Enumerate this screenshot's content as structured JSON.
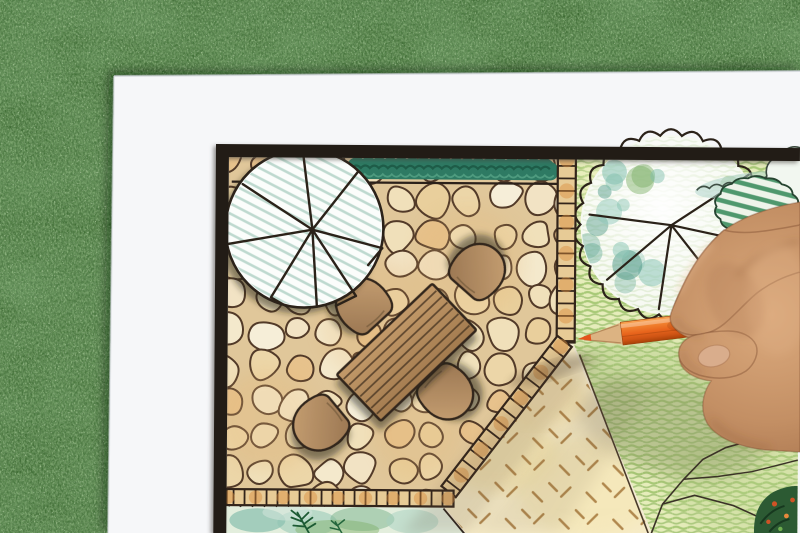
{
  "scene": {
    "kind": "photograph",
    "subject": "garden-landscape-plan-drawing-on-grass",
    "objects": [
      "grass-background",
      "white-paper-sheet",
      "garden-plan-drawing",
      "tree-symbols",
      "flagstone-patio",
      "garden-table",
      "garden-chairs",
      "hedges",
      "crayon-lawn",
      "gravel-area",
      "brick-edging",
      "orange-pencil",
      "artist-hand"
    ]
  },
  "counts": {
    "chairs": 4,
    "tree_symbols": 2
  },
  "palette": {
    "grass_base": "#3c6a31",
    "grass_dark": "#1e3d18",
    "grass_light": "#9cc27e",
    "paper": "#f6f7f9",
    "frame": "#241a14",
    "plan_bg": "#f3ead3",
    "grout": "#e0c79a",
    "stone_line": "#523a28",
    "hedge_green": "#2e7a63",
    "hedge_deep": "#1b5743",
    "lawn_base": "#e6edbb",
    "lawn_stroke": "#98c167",
    "gravel_base": "#f7ecc8",
    "gravel_dash": "#aa7d42",
    "ladder_fill": "#e7cb96",
    "ladder_line": "#32241a",
    "tree1_hatch": "#b4d3c8",
    "ink": "#2b2219",
    "wood_fill": "#b28a5e",
    "wood_line": "#4a3826",
    "bush_stripe": "#3e8e5f",
    "teal_wash": "#6fb3a4",
    "pencil_orange": "#e8641c",
    "pencil_wood": "#dcb382",
    "pencil_core": "#e4531a",
    "skin_mid": "#c38f64",
    "skin_light": "#dcab7e",
    "skin_deep": "#9e6a45"
  },
  "procedural": {
    "seed": 7,
    "patio": {
      "clip": "229,157 558,157 558,334 448,488 229,488",
      "bbox": [
        214,
        146,
        596,
        500
      ],
      "cell": 34,
      "palette": [
        "#f4e9cc",
        "#f0e0ba",
        "#ecd6a8",
        "#f6eed8",
        "#e9cf9c",
        "#f2e3c4",
        "#e7c28c"
      ],
      "line": "#523a28"
    },
    "ladders": [
      {
        "x1": 567,
        "y1": 151,
        "x2": 567,
        "y2": 340,
        "w": 18,
        "step": 12.5
      },
      {
        "x1": 566,
        "y1": 339,
        "x2": 451,
        "y2": 490,
        "w": 18,
        "step": 13
      },
      {
        "x1": 456,
        "y1": 497,
        "x2": 229,
        "y2": 497,
        "w": 16,
        "step": 11
      }
    ],
    "tree1": {
      "cx": 305,
      "cy": 228,
      "r": 79,
      "hub": [
        313,
        229
      ],
      "spokes": [
        [
          303,
          151
        ],
        [
          358,
          171
        ],
        [
          383,
          247
        ],
        [
          357,
          295
        ],
        [
          318,
          306
        ],
        [
          272,
          297
        ],
        [
          228,
          244
        ],
        [
          243,
          184
        ]
      ],
      "forks": [
        [
          357,
          295,
          337,
          305
        ],
        [
          272,
          297,
          288,
          306
        ],
        [
          383,
          247,
          369,
          264
        ]
      ]
    },
    "tree2": {
      "cx": 671,
      "cy": 222,
      "r": 90,
      "bumps": 26,
      "hub": [
        672,
        222
      ],
      "spokes": [
        [
          590,
          212
        ],
        [
          608,
          277
        ],
        [
          660,
          306
        ],
        [
          722,
          285
        ],
        [
          753,
          239
        ],
        [
          749,
          171
        ]
      ],
      "blotch_colors": [
        "#66ab99",
        "#7fbfae",
        "#4f9887",
        "#8cc6b8",
        "#7db068"
      ]
    },
    "bush": {
      "cx": 757,
      "cy": 203,
      "rx": 40,
      "ry": 29,
      "bumps": 14
    },
    "shrub_white": {
      "cx": 795,
      "cy": 172,
      "r": 28,
      "bumps": 10
    },
    "cloud_line": {
      "x1": 697,
      "y1": 187,
      "x2": 800,
      "y2": 171,
      "step": 13,
      "amp": 6
    },
    "hedge_top": {
      "x1": 348,
      "x2": 558,
      "y": 160,
      "h": 18
    },
    "bed_bottom": {
      "x1": 231,
      "x2": 445,
      "y": 506
    },
    "furniture": {
      "table": {
        "x": 408,
        "y": 351,
        "w": 132,
        "h": 64,
        "rot": -44,
        "planks": 7
      },
      "chairs": [
        {
          "x": 363,
          "y": 303,
          "rot": 47
        },
        {
          "x": 480,
          "y": 268,
          "rot": 131
        },
        {
          "x": 321,
          "y": 424,
          "rot": -40
        },
        {
          "x": 449,
          "y": 392,
          "rot": -135
        }
      ]
    },
    "gravel_poly": "574,344 654,533 470,533 447,505 458,492",
    "lawn_poly": "576,150 800,150 800,533 656,533 575,341"
  }
}
